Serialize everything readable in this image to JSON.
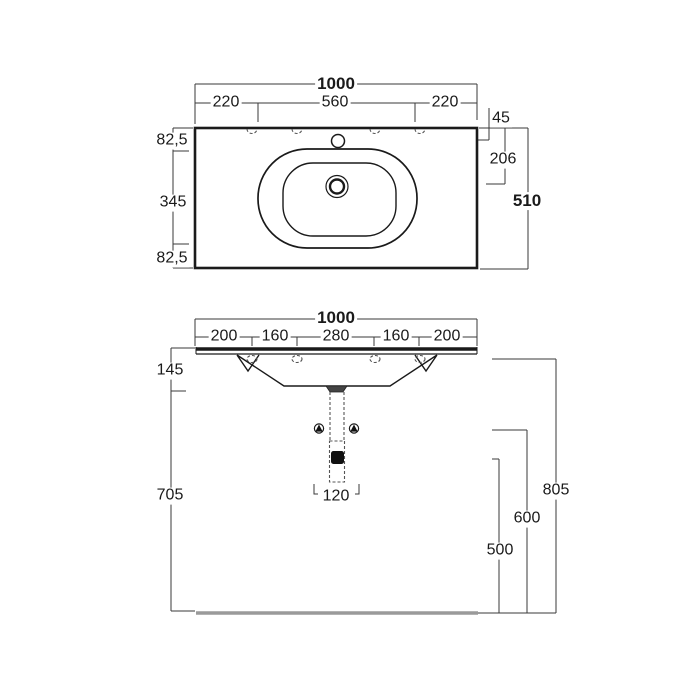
{
  "top_view": {
    "overall_width": "1000",
    "left_section": "220",
    "center_section": "560",
    "right_section": "220",
    "edge_to_faucet": "45",
    "edge_to_drain": "206",
    "overall_depth": "510",
    "depth_back": "82,5",
    "depth_middle": "345",
    "depth_front": "82,5"
  },
  "front_view": {
    "overall_width": "1000",
    "hole_spacing_1": "200",
    "hole_spacing_2": "160",
    "hole_spacing_3": "280",
    "hole_spacing_4": "160",
    "hole_spacing_5": "200",
    "basin_height": "145",
    "underside_clearance": "705",
    "trap_width": "120",
    "rim_height": "805",
    "supply_height": "600",
    "drain_height": "500"
  },
  "colors": {
    "line": "#1a1a1a",
    "dimension": "#3a3a3a",
    "hidden": "#555555",
    "floor": "#9a9a9a"
  }
}
